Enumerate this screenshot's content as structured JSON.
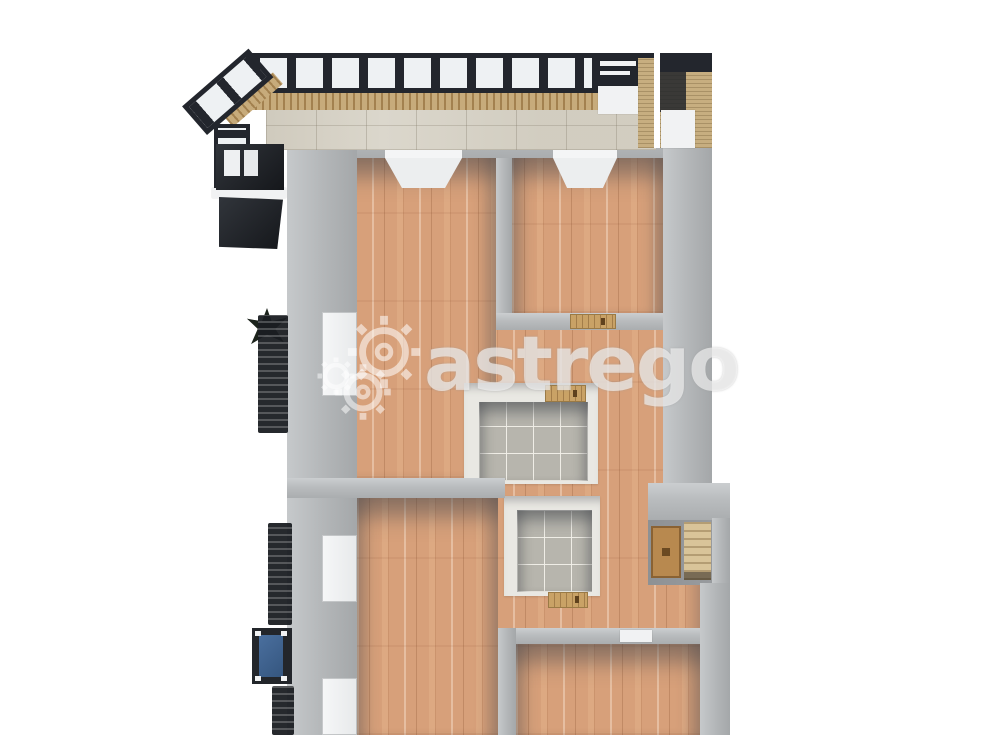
{
  "watermark": {
    "text": "astrego",
    "icon": "gear-icon",
    "color": "rgba(255,255,255,0.58)"
  },
  "palette": {
    "background": "#ffffff",
    "wall_gray": "#b6b9bb",
    "wall_inner_shadow": "#8f9296",
    "wood_floor": "#d7a07a",
    "tile_floor": "#b7b5ad",
    "bathroom_wall": "#e9e8e3",
    "balcony_frame": "#23262d",
    "glass_pane": "#eef1f3",
    "slat_wood": "#c7ab7b",
    "stone_tile": "#dbd7cc",
    "door_wood": "#c9a266",
    "railing_dark": "#1a1d22",
    "glass_blue": "#3d6191"
  },
  "scene": {
    "type": "3d-floor-plan-top-view",
    "rooms": [
      {
        "name": "balcony-winter-garden",
        "floor": "wood-slats-and-stone-tile"
      },
      {
        "name": "storage-compartment",
        "floor": "wood-walls"
      },
      {
        "name": "room-top-left",
        "floor": "wood"
      },
      {
        "name": "room-top-right",
        "floor": "wood"
      },
      {
        "name": "bathroom-upper",
        "floor": "tile"
      },
      {
        "name": "bathroom-lower",
        "floor": "tile"
      },
      {
        "name": "hallway",
        "floor": "wood"
      },
      {
        "name": "room-bottom-left",
        "floor": "wood"
      },
      {
        "name": "room-bottom-right",
        "floor": "wood"
      }
    ],
    "features": [
      "glazed-balcony-frame",
      "entrance-door-alcove",
      "wooden-door-thresholds",
      "left-wall-windows",
      "french-balcony-railings",
      "balcony-plant",
      "blue-glass-panel"
    ]
  }
}
